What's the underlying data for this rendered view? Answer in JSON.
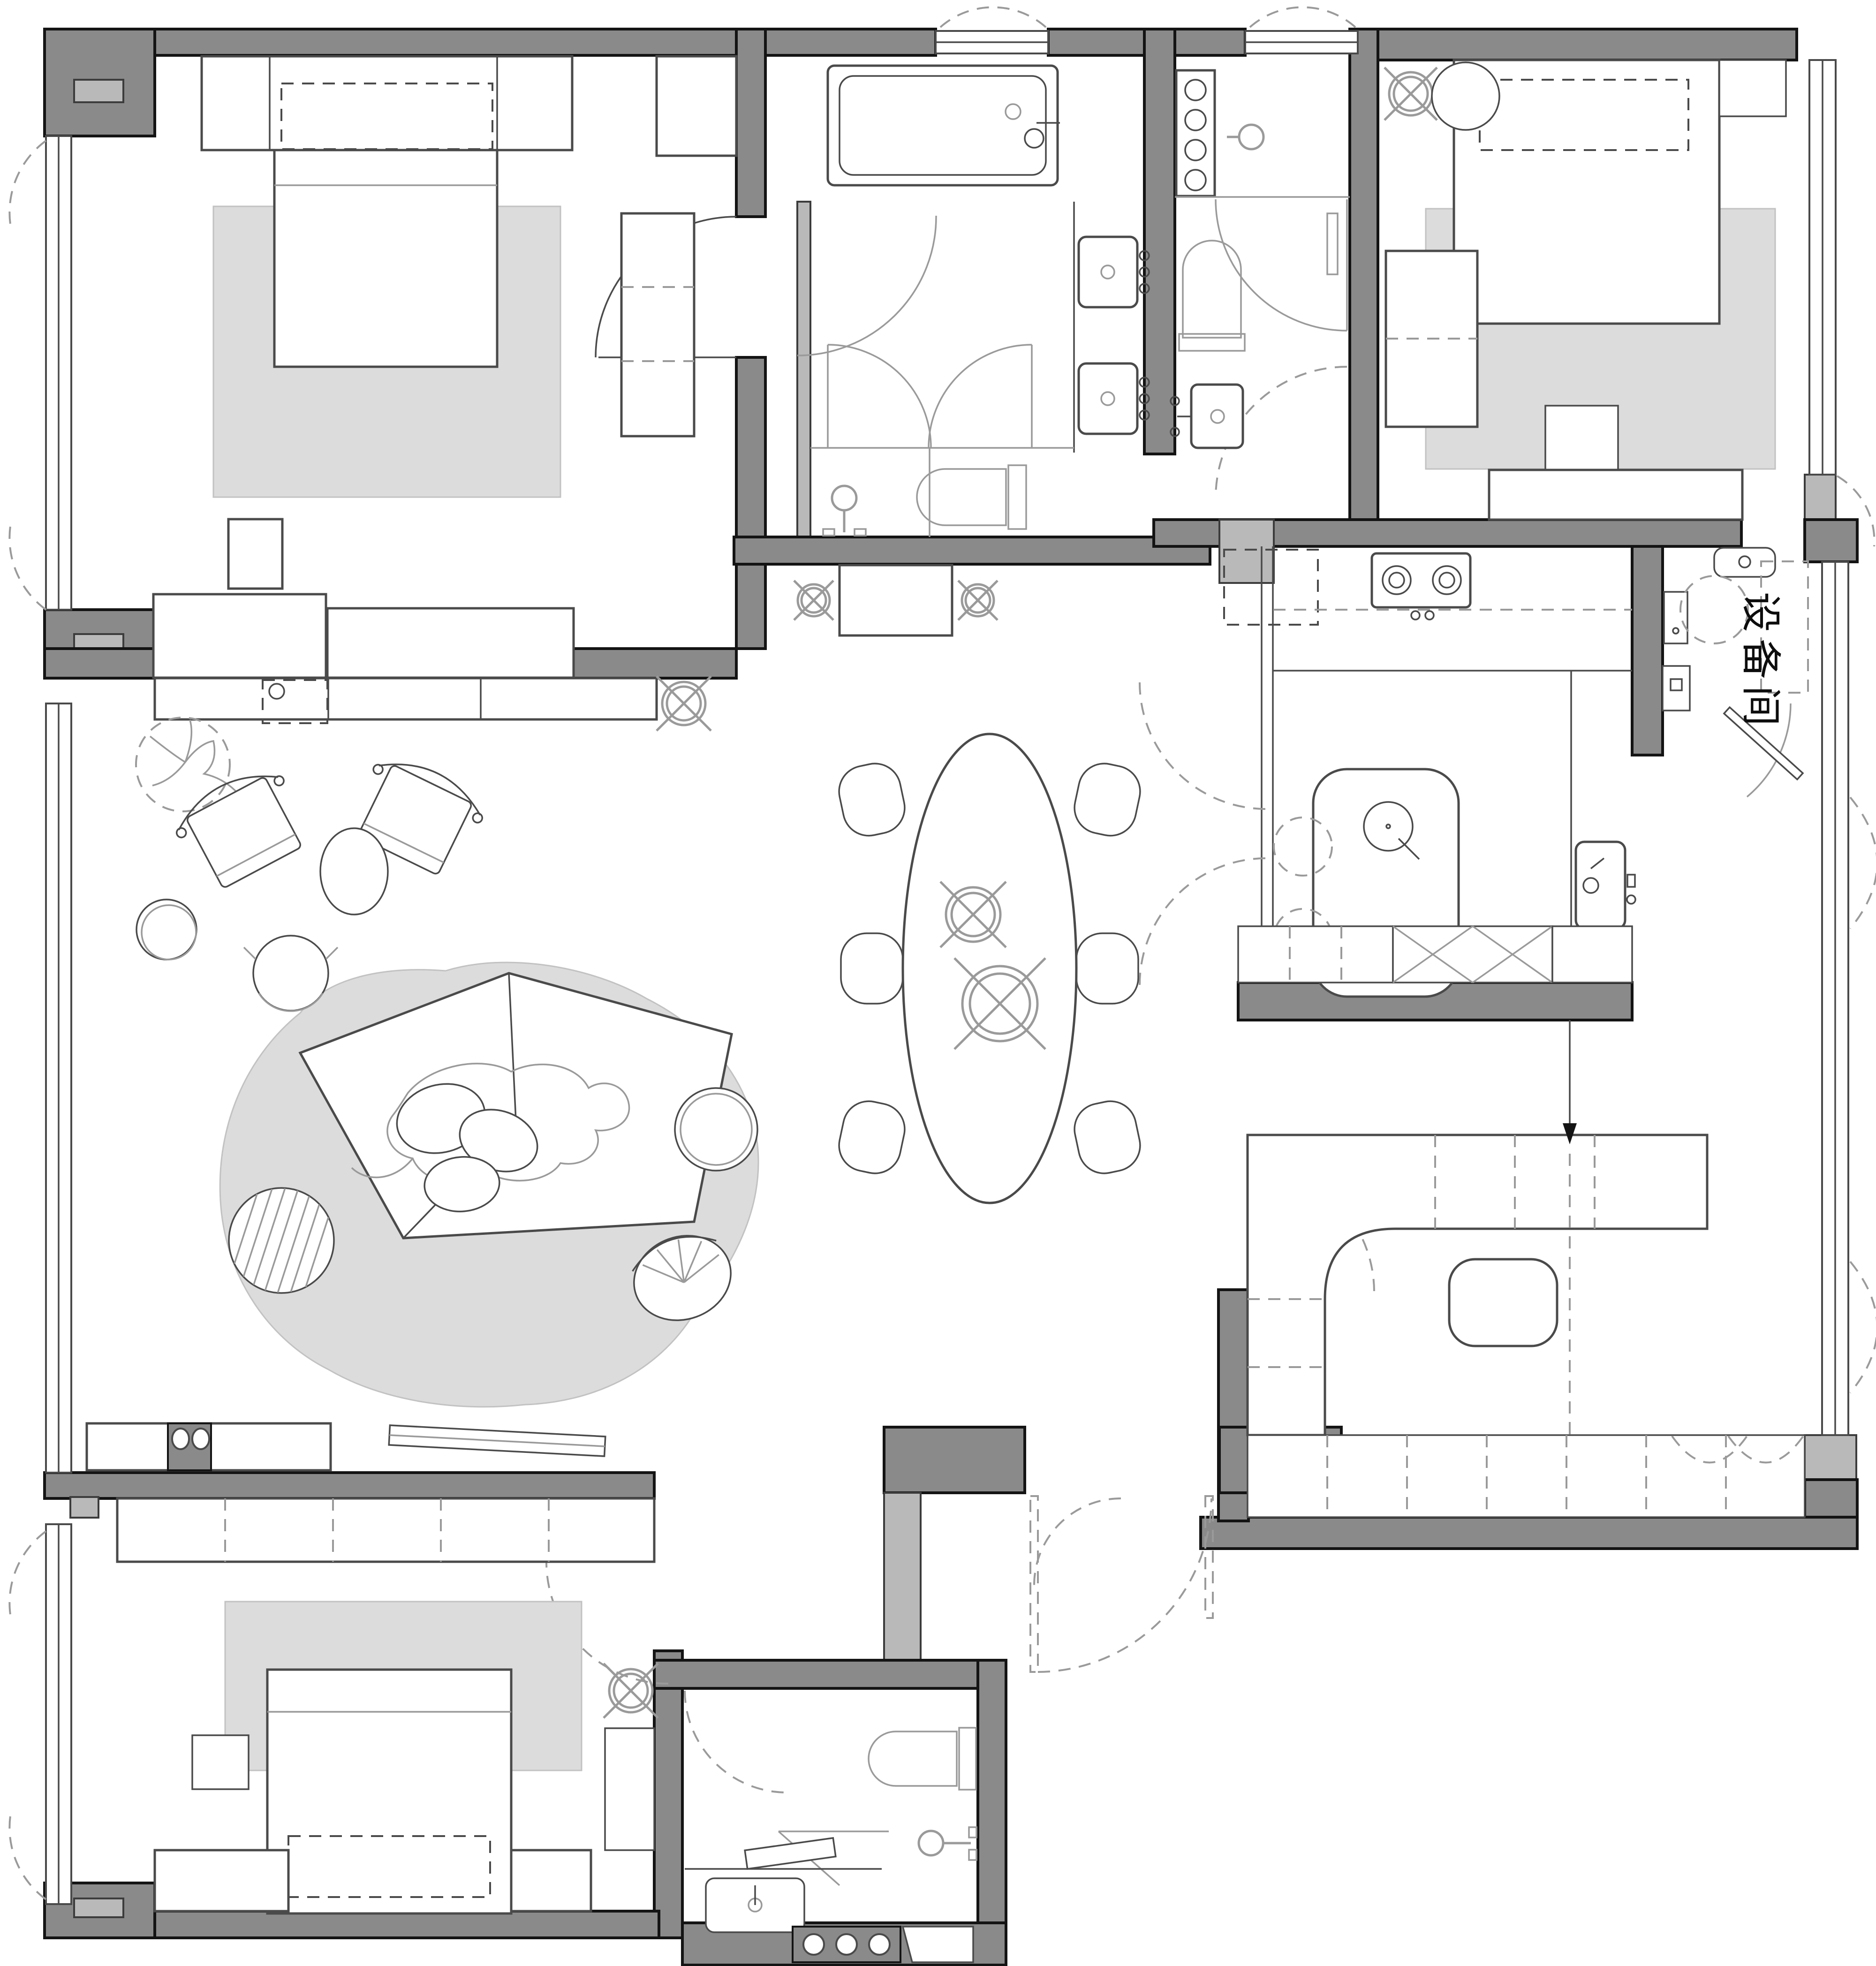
{
  "labels": {
    "equipment_room": "设备间"
  },
  "colors": {
    "wall": "#8a8a8a",
    "wall-light": "#b9b9b9",
    "outline": "#141414",
    "line": "#4a4a4a",
    "line-light": "#9a9a9a",
    "rug": "#dcdcdc",
    "rug-edge": "#c2c2c2",
    "bg": "#ffffff"
  },
  "symbols": {
    "ceiling_light": "crossed-circle",
    "door_swing": "quarter-arc",
    "window": "triple-line-band"
  }
}
